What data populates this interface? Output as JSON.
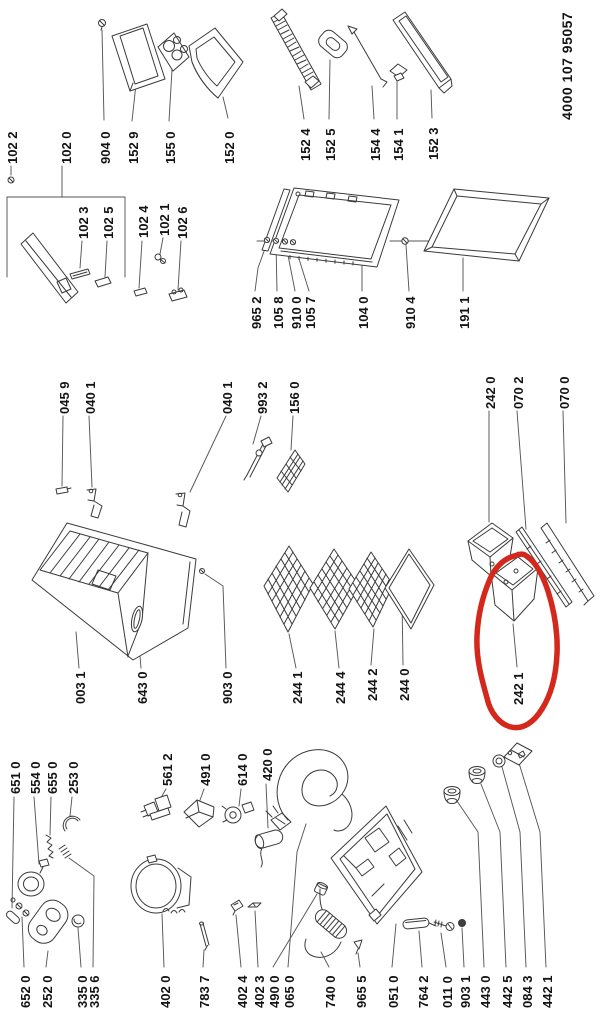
{
  "document": {
    "number": "4000 107 95057"
  },
  "annotation": {
    "shape": "freehand-circle",
    "color": "#d5281c",
    "circled_label": "242 1"
  },
  "labels": {
    "p102_2": "102 2",
    "p102_0": "102 0",
    "p904_0": "904 0",
    "p152_9": "152 9",
    "p155_0": "155 0",
    "p152_0": "152 0",
    "p152_4": "152 4",
    "p152_5": "152 5",
    "p154_4": "154 4",
    "p154_1": "154 1",
    "p152_3": "152 3",
    "p102_3": "102 3",
    "p102_5": "102 5",
    "p102_4": "102 4",
    "p102_1": "102 1",
    "p102_6": "102 6",
    "p965_2": "965 2",
    "p105_8": "105 8",
    "p910_0": "910 0",
    "p105_7": "105 7",
    "p104_0": "104 0",
    "p910_4": "910 4",
    "p191_1": "191 1",
    "p045_9": "045 9",
    "p040_1": "040 1",
    "p993_2": "993 2",
    "p156_0": "156 0",
    "p242_0": "242 0",
    "p070_2": "070 2",
    "p070_0": "070 0",
    "p003_1": "003 1",
    "p643_0": "643 0",
    "p903_0": "903 0",
    "p244_1": "244 1",
    "p244_4": "244 4",
    "p244_2": "244 2",
    "p244_0": "244 0",
    "p242_1": "242 1",
    "p651_0": "651 0",
    "p554_0": "554 0",
    "p655_0": "655 0",
    "p253_0": "253 0",
    "p561_2": "561 2",
    "p491_0": "491 0",
    "p614_0": "614 0",
    "p420_0": "420 0",
    "p652_0": "652 0",
    "p252_0": "252 0",
    "p335_0": "335 0",
    "p335_6": "335 6",
    "p402_0": "402 0",
    "p783_7": "783 7",
    "p402_4": "402 4",
    "p402_3": "402 3",
    "p490_0": "490 0",
    "p065_0": "065 0",
    "p740_0": "740 0",
    "p965_5": "965 5",
    "p051_0": "051 0",
    "p764_2": "764 2",
    "p011_0": "011 0",
    "p903_1": "903 1",
    "p443_0": "443 0",
    "p442_5": "442 5",
    "p084_3": "084 3",
    "p442_1": "442 1"
  }
}
